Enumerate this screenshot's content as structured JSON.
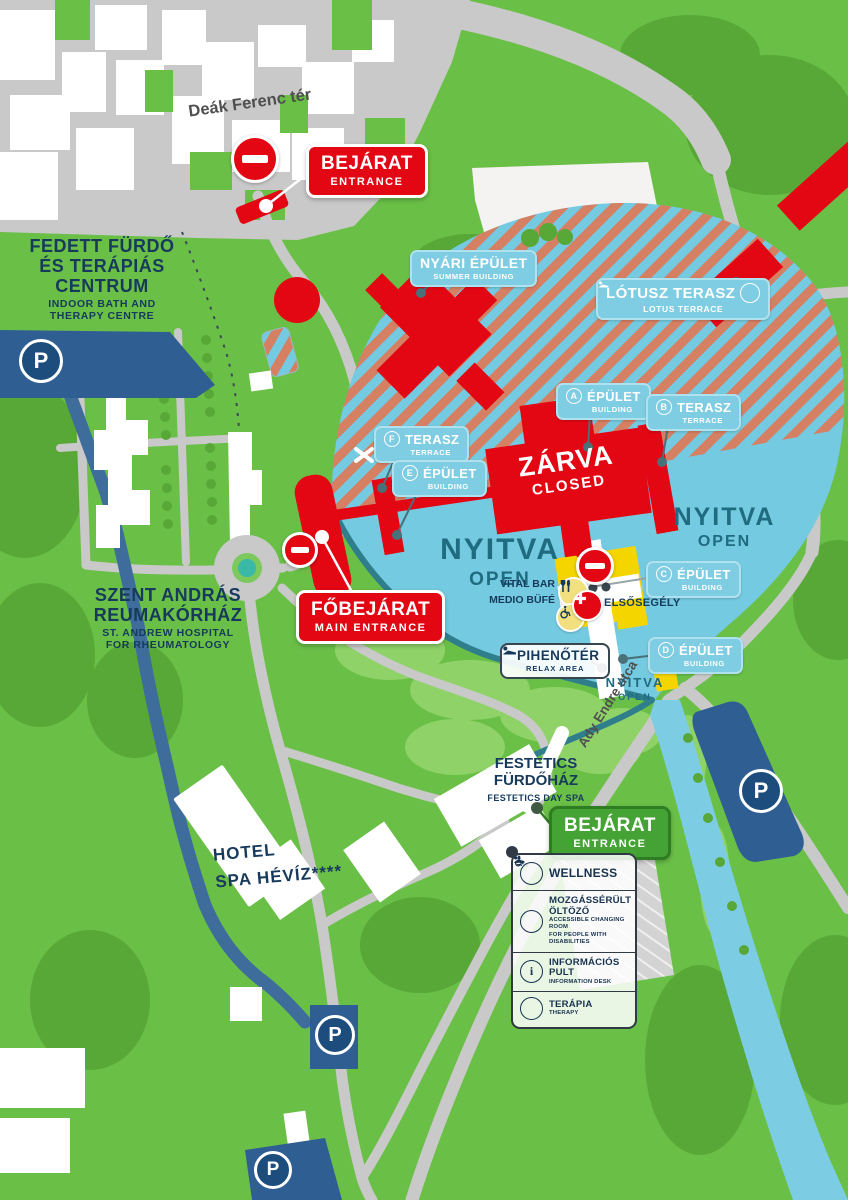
{
  "colors": {
    "background_green": "#6ABF47",
    "tree_green": "#57A837",
    "road_gray": "#C9C9C9",
    "closed_red": "#E30613",
    "open_lake_blue": "#74CAE0",
    "hatch_salmon": "#D57F63",
    "parking_navy": "#1D4D7C",
    "canal_blue": "#3E6D9C",
    "badge_blue": "#7FCDE2",
    "entrance_green": "#45A335",
    "navy_text": "#16395C",
    "open_text_teal": "#1F6B80",
    "yellow_building": "#F5D500"
  },
  "streets": {
    "deak": "Deák Ferenc tér",
    "ady": "Ady Endre utca"
  },
  "entrances": {
    "north": {
      "title": "BEJÁRAT",
      "subtitle": "ENTRANCE"
    },
    "main": {
      "title": "FŐBEJÁRAT",
      "subtitle": "MAIN ENTRANCE"
    },
    "festetics": {
      "title": "BEJÁRAT",
      "subtitle": "ENTRANCE"
    }
  },
  "places": {
    "indoor_bath": {
      "line1": "FEDETT FÜRDŐ",
      "line2": "ÉS TERÁPIÁS",
      "line3": "CENTRUM",
      "sub1": "INDOOR BATH AND",
      "sub2": "THERAPY CENTRE"
    },
    "hospital": {
      "line1": "SZENT ANDRÁS",
      "line2": "REUMAKÓRHÁZ",
      "sub1": "ST. ANDREW HOSPITAL",
      "sub2": "FOR RHEUMATOLOGY"
    },
    "hotel": {
      "line1": "HOTEL",
      "line2": "SPA HÉVÍZ****"
    },
    "festetics": {
      "line1": "FESTETICS",
      "line2": "FÜRDŐHÁZ",
      "sub": "FESTETICS DAY SPA"
    },
    "summer": {
      "title": "NYÁRI ÉPÜLET",
      "sub": "SUMMER BUILDING"
    },
    "lotus": {
      "title": "LÓTUSZ TERASZ",
      "sub": "LOTUS TERRACE"
    },
    "relax": {
      "title": "PIHENŐTÉR",
      "sub": "RELAX AREA"
    },
    "vital": {
      "line1": "VITAL BAR",
      "line2": "MEDIO BÜFÉ"
    },
    "first_aid": "ELSŐSEGÉLY"
  },
  "buildings": [
    {
      "letter": "A",
      "name": "ÉPÜLET",
      "sub": "BUILDING"
    },
    {
      "letter": "B",
      "name": "TERASZ",
      "sub": "TERRACE"
    },
    {
      "letter": "C",
      "name": "ÉPÜLET",
      "sub": "BUILDING"
    },
    {
      "letter": "D",
      "name": "ÉPÜLET",
      "sub": "BUILDING"
    },
    {
      "letter": "E",
      "name": "ÉPÜLET",
      "sub": "BUILDING"
    },
    {
      "letter": "F",
      "name": "TERASZ",
      "sub": "TERRACE"
    }
  ],
  "status": {
    "open": "NYITVA",
    "open_en": "OPEN",
    "closed": "ZÁRVA",
    "closed_en": "CLOSED"
  },
  "legend": {
    "items": [
      {
        "title": "WELLNESS",
        "sub1": "",
        "sub2": ""
      },
      {
        "title": "MOZGÁSSÉRÜLT ÖLTÖZŐ",
        "sub1": "ACCESSIBLE CHANGING ROOM",
        "sub2": "FOR PEOPLE WITH DISABILITIES"
      },
      {
        "title": "INFORMÁCIÓS PULT",
        "sub1": "INFORMATION DESK",
        "sub2": ""
      },
      {
        "title": "TERÁPIA",
        "sub1": "THERAPY",
        "sub2": ""
      }
    ]
  },
  "icons": {
    "parking_letter": "P",
    "info_letter": "i"
  }
}
